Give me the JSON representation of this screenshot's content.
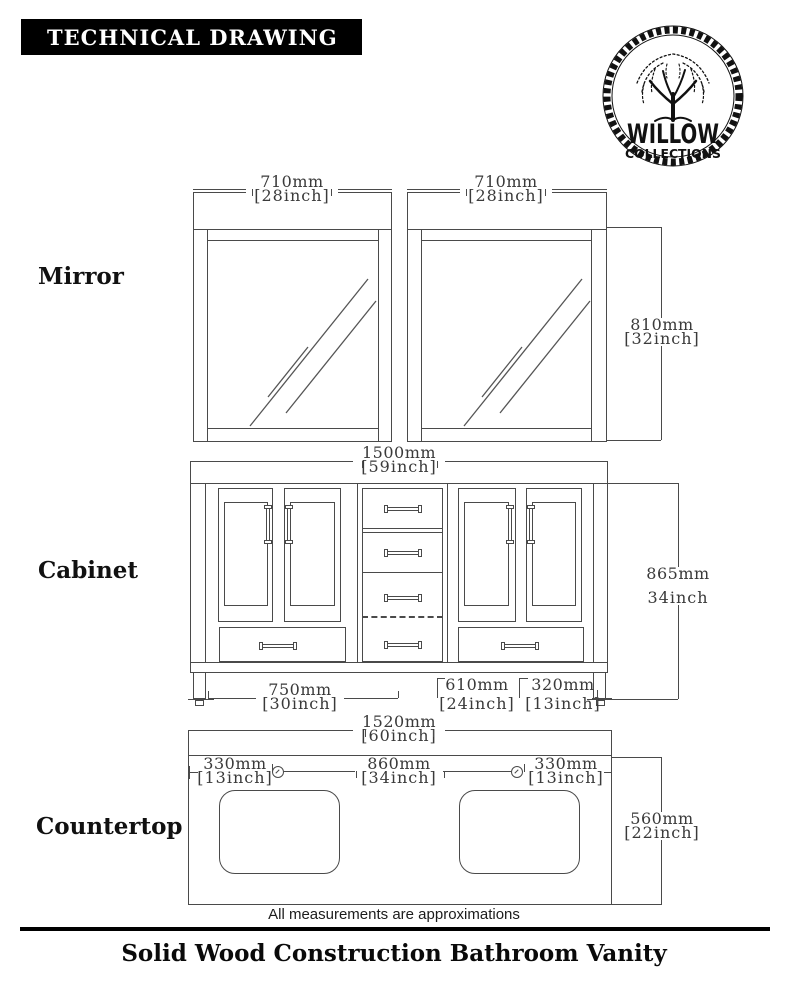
{
  "banner": {
    "title": "TECHNICAL DRAWING"
  },
  "logo": {
    "name": "WILLOW",
    "subname": "COLLECTIONS"
  },
  "sections": {
    "mirror": "Mirror",
    "cabinet": "Cabinet",
    "countertop": "Countertop"
  },
  "dims": {
    "mirror_left_width": {
      "mm": "710mm",
      "inch": "[28inch]"
    },
    "mirror_right_width": {
      "mm": "710mm",
      "inch": "[28inch]"
    },
    "mirror_height": {
      "mm": "810mm",
      "inch": "[32inch]"
    },
    "cabinet_width": {
      "mm": "1500mm",
      "inch": "[59inch]"
    },
    "cabinet_height": {
      "mm": "865mm",
      "inch": "34inch"
    },
    "cabinet_left_section": {
      "mm": "750mm",
      "inch": "[30inch]"
    },
    "cabinet_center_section": {
      "mm": "610mm",
      "inch": "[24inch]"
    },
    "cabinet_right_section": {
      "mm": "320mm",
      "inch": "[13inch]"
    },
    "countertop_width": {
      "mm": "1520mm",
      "inch": "[60inch]"
    },
    "countertop_left_offset": {
      "mm": "330mm",
      "inch": "[13inch]"
    },
    "countertop_center_span": {
      "mm": "860mm",
      "inch": "[34inch]"
    },
    "countertop_right_offset": {
      "mm": "330mm",
      "inch": "[13inch]"
    },
    "countertop_depth": {
      "mm": "560mm",
      "inch": "[22inch]"
    }
  },
  "footer": {
    "note": "All measurements are approximations",
    "title": "Solid Wood Construction Bathroom Vanity"
  },
  "colors": {
    "line": "#4a4a4a",
    "banner_bg": "#000000",
    "ink": "#111111"
  }
}
